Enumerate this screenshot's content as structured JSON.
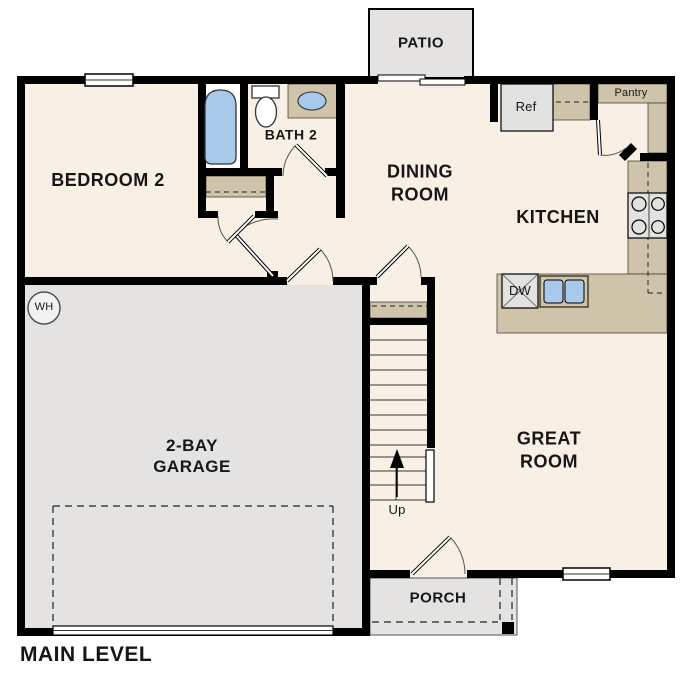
{
  "plan_title": "MAIN LEVEL",
  "labels": {
    "patio": "PATIO",
    "bedroom2": "BEDROOM 2",
    "bath2": "BATH 2",
    "dining_line1": "DINING",
    "dining_line2": "ROOM",
    "kitchen": "KITCHEN",
    "pantry": "Pantry",
    "ref": "Ref",
    "dw": "DW",
    "garage_line1": "2-BAY",
    "garage_line2": "GARAGE",
    "great_line1": "GREAT",
    "great_line2": "ROOM",
    "up": "Up",
    "porch": "PORCH",
    "wh": "WH"
  },
  "colors": {
    "floor": "#f8f0e5",
    "surface": "#e4e3e1",
    "counter": "#cfc3aa",
    "fixture_blue": "#a9c9ea",
    "wall": "#000000",
    "line": "#333333"
  }
}
